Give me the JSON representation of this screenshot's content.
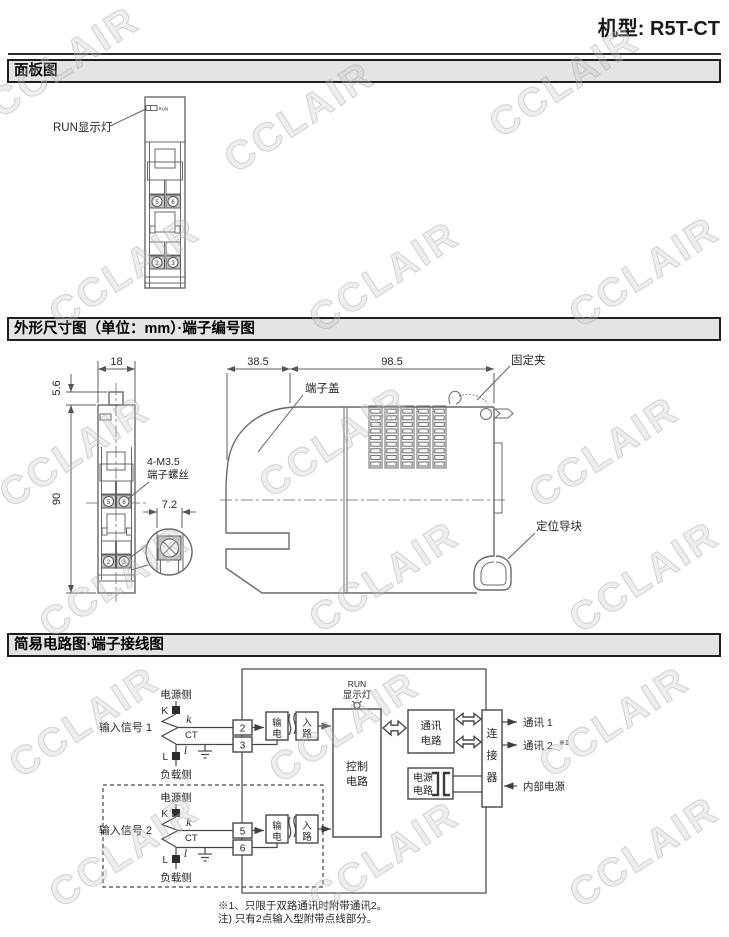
{
  "header": {
    "model": "机型: R5T-CT"
  },
  "watermark": {
    "text": "CCLAIR"
  },
  "sections": [
    {
      "title": "面板图"
    },
    {
      "title": "外形尺寸图（单位：mm）·端子编号图"
    },
    {
      "title": "简易电路图·端子接线图"
    }
  ],
  "panel_diagram": {
    "run_pointer_label": "RUN显示灯",
    "led_text": "RUN",
    "terminals": {
      "upper": [
        "5",
        "6"
      ],
      "lower": [
        "2",
        "3"
      ]
    }
  },
  "dimension_diagram": {
    "front": {
      "width_mm": "18",
      "knob_mm": "5.6",
      "height_mm": "90",
      "screw_pitch_mm": "7.2",
      "screw_note": [
        "4-M3.5",
        "端子螺丝"
      ],
      "terminals": {
        "upper": [
          "5",
          "6"
        ],
        "lower": [
          "2",
          "3"
        ]
      }
    },
    "side": {
      "cover_mm": "38.5",
      "body_mm": "98.5",
      "labels": {
        "terminal_cover": "端子盖",
        "fixing_clip": "固定夹",
        "guide_block": "定位导块"
      }
    }
  },
  "circuit_diagram": {
    "inputs": [
      {
        "name": "输入信号 1",
        "power_side": "电源侧",
        "load_side": "负载侧",
        "k": "K",
        "l": "L",
        "k_small": "k",
        "l_small": "l",
        "ct": "CT",
        "terminal_top": "2",
        "terminal_bottom": "3"
      },
      {
        "name": "输入信号 2",
        "power_side": "电源侧",
        "load_side": "负载侧",
        "k": "K",
        "l": "L",
        "k_small": "k",
        "l_small": "l",
        "ct": "CT",
        "terminal_top": "5",
        "terminal_bottom": "6"
      }
    ],
    "blocks": {
      "input_circuit": [
        "输",
        "电",
        "入",
        "路"
      ],
      "control": [
        "控制",
        "电路"
      ],
      "comm": [
        "通讯",
        "电路"
      ],
      "power": [
        "电源",
        "电路"
      ],
      "connector": [
        "连",
        "接",
        "器"
      ]
    },
    "run_lamp": [
      "RUN",
      "显示灯"
    ],
    "outputs": {
      "comm1": "通讯 1",
      "comm2": "通讯 2",
      "comm2_ref": "※1",
      "internal_power": "内部电源"
    },
    "notes": [
      "※1、只限于双路通讯时附带通讯2。",
      "注) 只有2点输入型附带点线部分。"
    ]
  }
}
